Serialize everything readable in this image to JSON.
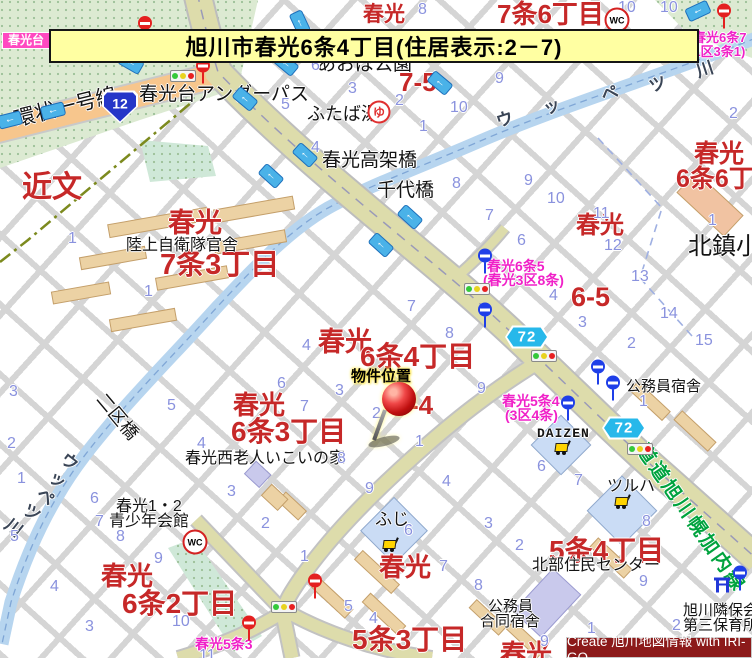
{
  "title": {
    "text": "旭川市春光6条4丁目(住居表示:2－7)"
  },
  "credit": {
    "text": "Create 旭川地図情報 with IRI-GO"
  },
  "colors": {
    "district_red": "#c62828",
    "area_pink": "#f021c8",
    "block_number_blue": "#8a92de",
    "road_name_green": "#00a33e",
    "route12_blue": "#2536c8",
    "route72_cyan": "#27b8ea",
    "banner_yellow": "#ffffa2",
    "credit_maroon": "#8c1a1a",
    "river_blue": "#b7d5ef",
    "main_road_khaki": "#dddcab",
    "ring_road_orange": "#f7c68d",
    "building_tan": "#ecd2a4"
  },
  "labels": [
    {
      "t": "春光",
      "x": 363,
      "y": 4,
      "s": 21,
      "c": "red"
    },
    {
      "t": "7条6丁目",
      "x": 497,
      "y": 1,
      "s": 26,
      "c": "red"
    },
    {
      "t": "春光",
      "x": 694,
      "y": 141,
      "s": 25,
      "c": "red"
    },
    {
      "t": "6条6丁目",
      "x": 676,
      "y": 166,
      "s": 25,
      "c": "red"
    },
    {
      "t": "近文",
      "x": 22,
      "y": 172,
      "s": 30,
      "c": "red"
    },
    {
      "t": "春光",
      "x": 168,
      "y": 209,
      "s": 27,
      "c": "red"
    },
    {
      "t": "7条3丁目",
      "x": 160,
      "y": 250,
      "s": 29,
      "c": "red"
    },
    {
      "t": "7-5",
      "x": 399,
      "y": 69,
      "s": 26,
      "c": "red"
    },
    {
      "t": "春光",
      "x": 576,
      "y": 213,
      "s": 24,
      "c": "red"
    },
    {
      "t": "6-5",
      "x": 571,
      "y": 283,
      "s": 27,
      "c": "red"
    },
    {
      "t": "春光",
      "x": 318,
      "y": 328,
      "s": 27,
      "c": "red"
    },
    {
      "t": "6条4丁目",
      "x": 360,
      "y": 342,
      "s": 28,
      "c": "red"
    },
    {
      "t": "-4",
      "x": 410,
      "y": 392,
      "s": 26,
      "c": "red"
    },
    {
      "t": "春光",
      "x": 233,
      "y": 392,
      "s": 26,
      "c": "red"
    },
    {
      "t": "6条3丁目",
      "x": 231,
      "y": 417,
      "s": 28,
      "c": "red"
    },
    {
      "t": "春光",
      "x": 101,
      "y": 563,
      "s": 26,
      "c": "red"
    },
    {
      "t": "6条2丁目",
      "x": 122,
      "y": 589,
      "s": 28,
      "c": "red"
    },
    {
      "t": "春光",
      "x": 379,
      "y": 554,
      "s": 26,
      "c": "red"
    },
    {
      "t": "5条3丁目",
      "x": 352,
      "y": 625,
      "s": 28,
      "c": "red"
    },
    {
      "t": "5条4丁目",
      "x": 549,
      "y": 536,
      "s": 28,
      "c": "red"
    },
    {
      "t": "春光",
      "x": 500,
      "y": 641,
      "s": 26,
      "c": "red"
    },
    {
      "t": "春光台アンダーパス",
      "x": 139,
      "y": 85,
      "s": 19,
      "c": "black"
    },
    {
      "t": "環状一号線",
      "x": 12,
      "y": 110,
      "s": 21,
      "c": "black",
      "r": -14
    },
    {
      "t": "あおば公園",
      "x": 317,
      "y": 55,
      "s": 19,
      "c": "black"
    },
    {
      "t": "ふたば湯",
      "x": 307,
      "y": 105,
      "s": 18,
      "c": "black"
    },
    {
      "t": "春光高架橋",
      "x": 322,
      "y": 151,
      "s": 19,
      "c": "black"
    },
    {
      "t": "千代橋",
      "x": 377,
      "y": 181,
      "s": 19,
      "c": "black"
    },
    {
      "t": "陸上自衛隊官舎",
      "x": 126,
      "y": 238,
      "s": 16,
      "c": "black"
    },
    {
      "t": "北鎮小",
      "x": 688,
      "y": 234,
      "s": 24,
      "c": "black"
    },
    {
      "t": "二区橋",
      "x": 107,
      "y": 390,
      "s": 18,
      "c": "black",
      "r": 50
    },
    {
      "t": "春光西老人いこいの家",
      "x": 185,
      "y": 451,
      "s": 16,
      "c": "black"
    },
    {
      "t": "春光1・2",
      "x": 116,
      "y": 499,
      "s": 16,
      "c": "black"
    },
    {
      "t": "青少年会館",
      "x": 109,
      "y": 514,
      "s": 16,
      "c": "black"
    },
    {
      "t": "ふじ",
      "x": 375,
      "y": 511,
      "s": 17,
      "c": "black"
    },
    {
      "t": "DAIZEN",
      "x": 537,
      "y": 427,
      "s": 13,
      "c": "black mono"
    },
    {
      "t": "ツルハ",
      "x": 607,
      "y": 479,
      "s": 16,
      "c": "black"
    },
    {
      "t": "公務員宿舎",
      "x": 626,
      "y": 379,
      "s": 15,
      "c": "black"
    },
    {
      "t": "公務員",
      "x": 488,
      "y": 599,
      "s": 15,
      "c": "black"
    },
    {
      "t": "合同宿舎",
      "x": 480,
      "y": 614,
      "s": 15,
      "c": "black"
    },
    {
      "t": "北部住民センター",
      "x": 532,
      "y": 558,
      "s": 16,
      "c": "black"
    },
    {
      "t": "旭川隣保会",
      "x": 683,
      "y": 603,
      "s": 15,
      "c": "black"
    },
    {
      "t": "第三保育所",
      "x": 683,
      "y": 618,
      "s": 15,
      "c": "black"
    },
    {
      "t": "物件位置",
      "x": 351,
      "y": 369,
      "s": 15,
      "c": "black marker-label"
    },
    {
      "t": "道道旭川幌加内線",
      "x": 648,
      "y": 441,
      "s": 19,
      "c": "green",
      "r": 55
    },
    {
      "t": "ウ",
      "x": 494,
      "y": 114,
      "s": 17,
      "c": "river",
      "r": -18
    },
    {
      "t": "ッ",
      "x": 541,
      "y": 101,
      "s": 17,
      "c": "river",
      "r": -18
    },
    {
      "t": "ペ",
      "x": 599,
      "y": 88,
      "s": 17,
      "c": "river",
      "r": -18
    },
    {
      "t": "ツ",
      "x": 647,
      "y": 79,
      "s": 17,
      "c": "river",
      "r": -18
    },
    {
      "t": "川",
      "x": 694,
      "y": 64,
      "s": 17,
      "c": "river",
      "r": -18
    },
    {
      "t": "ウ",
      "x": 68,
      "y": 450,
      "s": 17,
      "c": "river",
      "r": 38
    },
    {
      "t": "ッ",
      "x": 56,
      "y": 468,
      "s": 17,
      "c": "river",
      "r": 38
    },
    {
      "t": "ペ",
      "x": 44,
      "y": 485,
      "s": 17,
      "c": "river",
      "r": 38
    },
    {
      "t": "ツ",
      "x": 30,
      "y": 501,
      "s": 17,
      "c": "river",
      "r": 38
    },
    {
      "t": "川",
      "x": 12,
      "y": 516,
      "s": 17,
      "c": "river",
      "r": 38
    },
    {
      "t": "春光台",
      "x": 2,
      "y": 32,
      "s": 12,
      "c": "pinkbox"
    },
    {
      "t": "春光6条7",
      "x": 693,
      "y": 31,
      "s": 13,
      "c": "pink"
    },
    {
      "t": "(1区3条1)",
      "x": 689,
      "y": 45,
      "s": 13,
      "c": "pink"
    },
    {
      "t": "春光6条5",
      "x": 487,
      "y": 259,
      "s": 14,
      "c": "pink"
    },
    {
      "t": "(春光3区8条)",
      "x": 483,
      "y": 273,
      "s": 14,
      "c": "pink"
    },
    {
      "t": "春光5条4",
      "x": 502,
      "y": 394,
      "s": 14,
      "c": "pink"
    },
    {
      "t": "(3区4条)",
      "x": 505,
      "y": 408,
      "s": 14,
      "c": "pink"
    },
    {
      "t": "春光5条3",
      "x": 195,
      "y": 637,
      "s": 14,
      "c": "pink"
    }
  ],
  "block_numbers": [
    [
      "8",
      418,
      2
    ],
    [
      "10",
      618,
      0
    ],
    [
      "10",
      660,
      0
    ],
    [
      "6",
      311,
      58
    ],
    [
      "3",
      348,
      81
    ],
    [
      "2",
      395,
      93
    ],
    [
      "5",
      281,
      97
    ],
    [
      "9",
      495,
      71
    ],
    [
      "10",
      450,
      100
    ],
    [
      "1",
      419,
      119
    ],
    [
      "2",
      729,
      106
    ],
    [
      "4",
      311,
      140
    ],
    [
      "8",
      452,
      176
    ],
    [
      "9",
      524,
      173
    ],
    [
      "10",
      547,
      191
    ],
    [
      "7",
      485,
      208
    ],
    [
      "11",
      593,
      206
    ],
    [
      "6",
      517,
      233
    ],
    [
      "12",
      604,
      238
    ],
    [
      "13",
      631,
      269
    ],
    [
      "4",
      549,
      288
    ],
    [
      "3",
      578,
      315
    ],
    [
      "14",
      660,
      306
    ],
    [
      "2",
      627,
      336
    ],
    [
      "15",
      695,
      333
    ],
    [
      "1",
      708,
      213
    ],
    [
      "1",
      68,
      231
    ],
    [
      "1",
      144,
      284
    ],
    [
      "4",
      302,
      338
    ],
    [
      "8",
      445,
      326
    ],
    [
      "3",
      335,
      383
    ],
    [
      "2",
      372,
      406
    ],
    [
      "9",
      477,
      381
    ],
    [
      "1",
      415,
      434
    ],
    [
      "6",
      277,
      376
    ],
    [
      "7",
      300,
      399
    ],
    [
      "7",
      407,
      299
    ],
    [
      "8",
      337,
      451
    ],
    [
      "3",
      9,
      384
    ],
    [
      "2",
      7,
      436
    ],
    [
      "1",
      17,
      471
    ],
    [
      "5",
      167,
      398
    ],
    [
      "6",
      90,
      491
    ],
    [
      "7",
      95,
      514
    ],
    [
      "8",
      116,
      529
    ],
    [
      "9",
      154,
      551
    ],
    [
      "4",
      197,
      436
    ],
    [
      "3",
      227,
      484
    ],
    [
      "2",
      261,
      516
    ],
    [
      "5",
      10,
      529
    ],
    [
      "4",
      50,
      579
    ],
    [
      "3",
      85,
      619
    ],
    [
      "10",
      172,
      614
    ],
    [
      "11",
      199,
      648
    ],
    [
      "9",
      365,
      481
    ],
    [
      "4",
      442,
      474
    ],
    [
      "3",
      484,
      516
    ],
    [
      "2",
      515,
      538
    ],
    [
      "1",
      300,
      549
    ],
    [
      "6",
      404,
      523
    ],
    [
      "7",
      439,
      559
    ],
    [
      "8",
      474,
      578
    ],
    [
      "5",
      344,
      599
    ],
    [
      "4",
      369,
      611
    ],
    [
      "6",
      537,
      459
    ],
    [
      "7",
      574,
      473
    ],
    [
      "8",
      642,
      514
    ],
    [
      "9",
      639,
      574
    ],
    [
      "1",
      587,
      621
    ],
    [
      "2",
      672,
      618
    ],
    [
      "9",
      540,
      634
    ],
    [
      "1",
      639,
      394
    ]
  ],
  "icons": [
    {
      "k": "traffic-light",
      "x": 183,
      "y": 76
    },
    {
      "k": "traffic-light",
      "x": 477,
      "y": 289
    },
    {
      "k": "traffic-light",
      "x": 544,
      "y": 356
    },
    {
      "k": "traffic-light",
      "x": 640,
      "y": 449
    },
    {
      "k": "traffic-light",
      "x": 284,
      "y": 607
    },
    {
      "k": "no-entry",
      "x": 145,
      "y": 23
    },
    {
      "k": "no-entry-pole",
      "x": 203,
      "y": 71
    },
    {
      "k": "no-entry-pole",
      "x": 724,
      "y": 16
    },
    {
      "k": "no-entry-pole",
      "x": 249,
      "y": 628
    },
    {
      "k": "no-entry-pole",
      "x": 315,
      "y": 586
    },
    {
      "k": "bus-stop",
      "x": 485,
      "y": 261
    },
    {
      "k": "bus-stop",
      "x": 485,
      "y": 315
    },
    {
      "k": "bus-stop",
      "x": 598,
      "y": 372
    },
    {
      "k": "bus-stop",
      "x": 613,
      "y": 388
    },
    {
      "k": "bus-stop",
      "x": 568,
      "y": 408
    },
    {
      "k": "bus-stop",
      "x": 740,
      "y": 578
    },
    {
      "k": "wc",
      "x": 617,
      "y": 20,
      "t": "WC"
    },
    {
      "k": "wc",
      "x": 195,
      "y": 542,
      "t": "WC"
    },
    {
      "k": "bath",
      "x": 379,
      "y": 112,
      "t": "ゆ"
    },
    {
      "k": "cart",
      "x": 390,
      "y": 544
    },
    {
      "k": "cart",
      "x": 562,
      "y": 447
    },
    {
      "k": "cart",
      "x": 622,
      "y": 501
    },
    {
      "k": "route-12",
      "x": 120,
      "y": 107,
      "t": "12"
    },
    {
      "k": "route-72",
      "x": 527,
      "y": 337,
      "t": "72"
    },
    {
      "k": "route-72",
      "x": 624,
      "y": 428,
      "t": "72"
    },
    {
      "k": "torii",
      "x": 722,
      "y": 585
    },
    {
      "k": "one-way-arrow",
      "x": 10,
      "y": 120,
      "r": -14
    },
    {
      "k": "one-way-arrow",
      "x": 53,
      "y": 111,
      "r": -14
    },
    {
      "k": "one-way-arrow",
      "x": 131,
      "y": 63,
      "r": 30
    },
    {
      "k": "one-way-arrow",
      "x": 245,
      "y": 99,
      "r": 40
    },
    {
      "k": "one-way-arrow",
      "x": 286,
      "y": 64,
      "r": 40
    },
    {
      "k": "one-way-arrow",
      "x": 300,
      "y": 23,
      "r": 65
    },
    {
      "k": "one-way-arrow",
      "x": 440,
      "y": 83,
      "r": 40
    },
    {
      "k": "one-way-arrow",
      "x": 698,
      "y": 11,
      "r": -25
    },
    {
      "k": "one-way-arrow",
      "x": 305,
      "y": 155,
      "r": 42
    },
    {
      "k": "one-way-arrow",
      "x": 271,
      "y": 176,
      "r": 42
    },
    {
      "k": "one-way-arrow",
      "x": 410,
      "y": 217,
      "r": 42
    },
    {
      "k": "one-way-arrow",
      "x": 381,
      "y": 245,
      "r": 42
    }
  ]
}
